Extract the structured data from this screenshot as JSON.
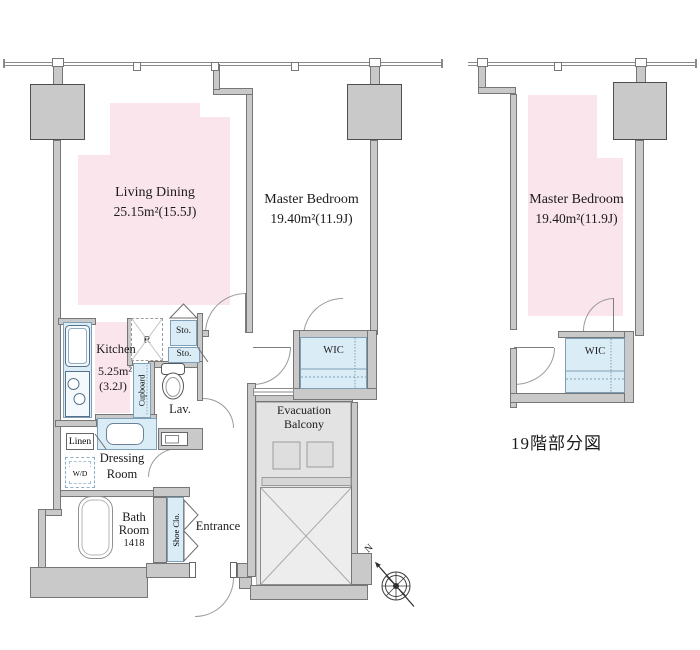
{
  "left_plan": {
    "rooms": {
      "living_dining": {
        "name": "Living Dining",
        "area": "25.15m²(15.5J)"
      },
      "master_bedroom": {
        "name": "Master Bedroom",
        "area": "19.40m²(11.9J)"
      },
      "kitchen": {
        "name": "Kitchen",
        "area_sqm": "5.25m²",
        "area_jo": "(3.2J)"
      },
      "lavatory": "Lav.",
      "dressing_room": {
        "line1": "Dressing",
        "line2": "Room"
      },
      "bath_room": {
        "line1": "Bath",
        "line2": "Room",
        "size": "1418"
      },
      "entrance": "Entrance",
      "wic": "WIC",
      "evacuation_balcony": {
        "line1": "Evacuation",
        "line2": "Balcony"
      }
    },
    "fixtures": {
      "storage_upper": "Sto.",
      "storage_lower": "Sto.",
      "refrigerator": "R",
      "cupboard": "Cupboard",
      "linen": "Linen",
      "washer_dryer": "W/D",
      "shoe_closet": "Shoe Clo."
    }
  },
  "right_plan": {
    "rooms": {
      "master_bedroom": {
        "name": "Master Bedroom",
        "area": "19.40m²(11.9J)"
      },
      "wic": "WIC"
    },
    "caption": "19階部分図"
  },
  "compass": {
    "north": "N"
  },
  "colors": {
    "room_pink": "#fbe5ed",
    "fixture_blue": "#daecf6",
    "wall_gray": "#c9c9c9",
    "balcony_gray": "#e3e3e3"
  }
}
